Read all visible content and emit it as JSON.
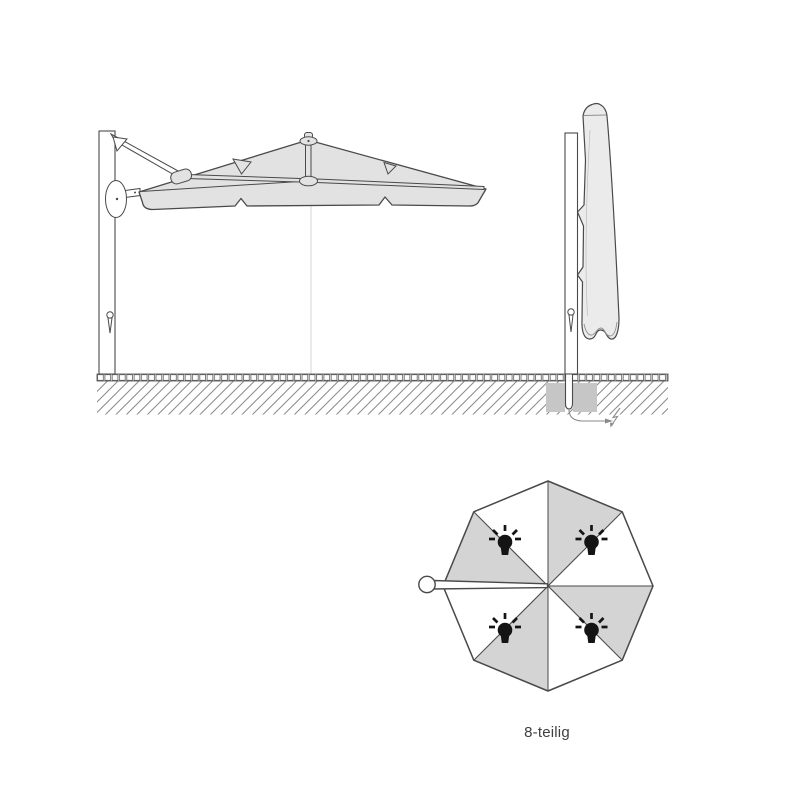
{
  "page": {
    "background": "#ffffff"
  },
  "colors": {
    "page_bg": "#ffffff",
    "outline": "#4a4a4a",
    "canopy_fill": "#e2e2e2",
    "cover_fill": "#ebebeb",
    "segment_gray": "#d4d4d4",
    "segment_white": "#ffffff",
    "foundation_gray": "#c6c6c6",
    "hatch": "#8a8a8a",
    "paving": "#5a5a5a",
    "cable": "#8a8a8a",
    "centerline": "#cccccc",
    "bulb": "#141414",
    "label_text": "#3f3f3f"
  },
  "top_view": {
    "label": "8-teilig",
    "segment_count": 8,
    "light_count": 4
  }
}
